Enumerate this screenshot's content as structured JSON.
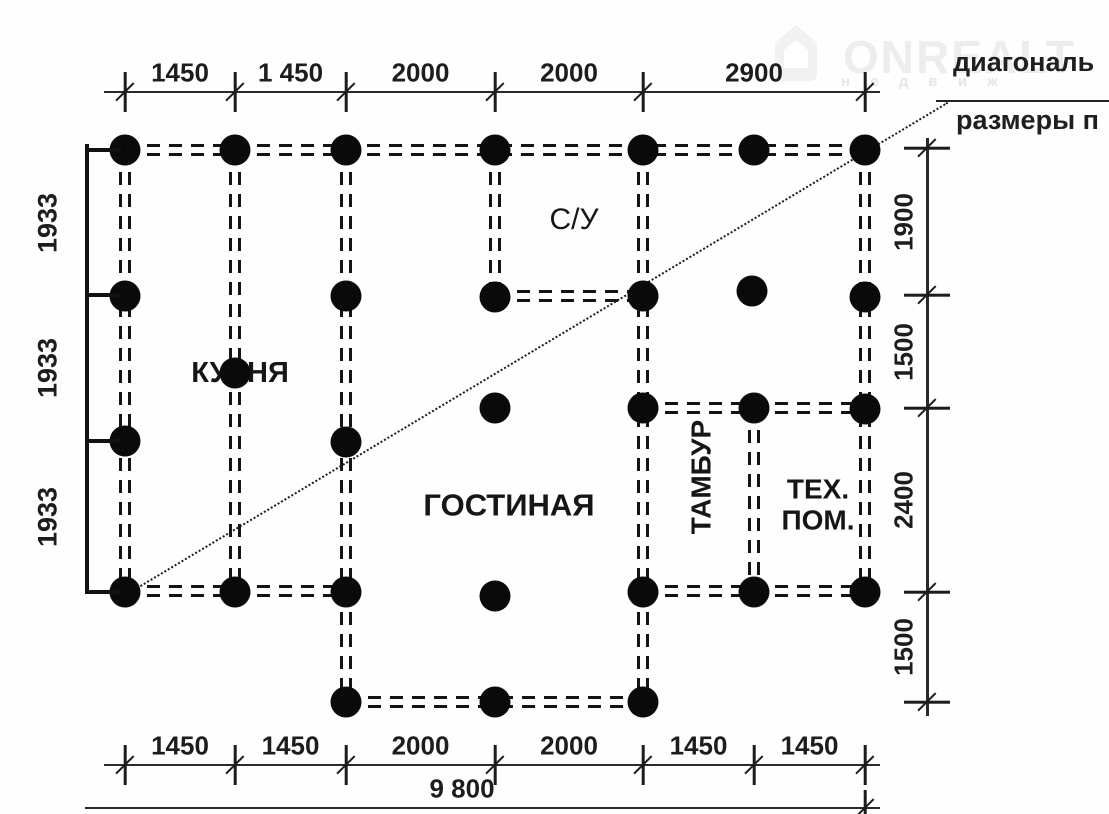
{
  "watermark": {
    "brand": "ONREALT",
    "sub": "н е д в и ж",
    "brand_color": "#ededed",
    "logo_color": "#f0f0f0"
  },
  "annotation": {
    "line1": "диагональ",
    "line2": "размеры п"
  },
  "rooms": [
    {
      "name": "kitchen",
      "label": "КУХНЯ",
      "x": 240,
      "y": 373,
      "size": 29,
      "weight": 700,
      "rotate": false
    },
    {
      "name": "bathroom",
      "label": "С/У",
      "x": 574,
      "y": 220,
      "size": 30,
      "weight": 500,
      "rotate": false
    },
    {
      "name": "living-room",
      "label": "ГОСТИНАЯ",
      "x": 509,
      "y": 506,
      "size": 31,
      "weight": 600,
      "rotate": false
    },
    {
      "name": "vestibule",
      "label": "ТАМБУР",
      "x": 701,
      "y": 477,
      "size": 28,
      "weight": 700,
      "rotate": true
    },
    {
      "name": "tech-room",
      "label": "ТЕХ.\nПОМ.",
      "x": 818,
      "y": 505,
      "size": 28,
      "weight": 700,
      "rotate": false
    }
  ],
  "dimensions": {
    "top": {
      "labels": [
        "1450",
        "1 450",
        "2000",
        "2000",
        "2900"
      ],
      "ticks_x": [
        125,
        235,
        346,
        495,
        643,
        865
      ],
      "line_y": 92,
      "line_x1": 104,
      "line_x2": 880,
      "label_y": 73
    },
    "bottom": {
      "labels": [
        "1450",
        "1450",
        "2000",
        "2000",
        "1450",
        "1450"
      ],
      "ticks_x": [
        125,
        235,
        346,
        495,
        643,
        754,
        865
      ],
      "line_y": 765,
      "line_x1": 104,
      "line_x2": 880,
      "label_y": 746
    },
    "left": {
      "labels": [
        "1933",
        "1933",
        "1933"
      ],
      "ticks_y": [
        150,
        295,
        441,
        592
      ],
      "line_x": 87,
      "line_y1": 144,
      "line_y2": 594,
      "label_x": 48
    },
    "right": {
      "labels": [
        "1900",
        "1500",
        "2400",
        "1500"
      ],
      "ticks_y": [
        148,
        295,
        408,
        592,
        702
      ],
      "line_x": 927,
      "line_y1": 138,
      "line_y2": 716,
      "label_x": 904
    },
    "total": {
      "label": "9 800",
      "line_y": 808,
      "line_x1": 85,
      "line_x2": 880,
      "tick_x": 865,
      "label_x": 462,
      "label_y": 789
    }
  },
  "plan": {
    "piles": [
      [
        125,
        150
      ],
      [
        235,
        150
      ],
      [
        346,
        150
      ],
      [
        495,
        150
      ],
      [
        643,
        150
      ],
      [
        754,
        150
      ],
      [
        865,
        150
      ],
      [
        125,
        296
      ],
      [
        346,
        296
      ],
      [
        495,
        297
      ],
      [
        643,
        296
      ],
      [
        752,
        291
      ],
      [
        865,
        297
      ],
      [
        235,
        373
      ],
      [
        495,
        408
      ],
      [
        643,
        408
      ],
      [
        754,
        408
      ],
      [
        865,
        409
      ],
      [
        125,
        441
      ],
      [
        346,
        442
      ],
      [
        125,
        592
      ],
      [
        235,
        592
      ],
      [
        346,
        592
      ],
      [
        495,
        596
      ],
      [
        643,
        592
      ],
      [
        754,
        592
      ],
      [
        865,
        592
      ],
      [
        346,
        702
      ],
      [
        495,
        702
      ],
      [
        643,
        702
      ]
    ],
    "walls_horizontal": [
      [
        125,
        865,
        150
      ],
      [
        495,
        643,
        296
      ],
      [
        643,
        865,
        408
      ],
      [
        125,
        346,
        591
      ],
      [
        643,
        865,
        591
      ],
      [
        346,
        643,
        702
      ]
    ],
    "walls_vertical": [
      [
        125,
        150,
        591
      ],
      [
        235,
        150,
        591
      ],
      [
        346,
        150,
        702
      ],
      [
        495,
        150,
        296
      ],
      [
        643,
        150,
        702
      ],
      [
        754,
        408,
        591
      ],
      [
        865,
        150,
        591
      ]
    ],
    "diagonal": {
      "x1": 127,
      "y1": 593,
      "x2": 947,
      "y2": 102
    },
    "leader": {
      "x1": 936,
      "y1": 100,
      "x2": 1109,
      "y2": 100
    }
  }
}
